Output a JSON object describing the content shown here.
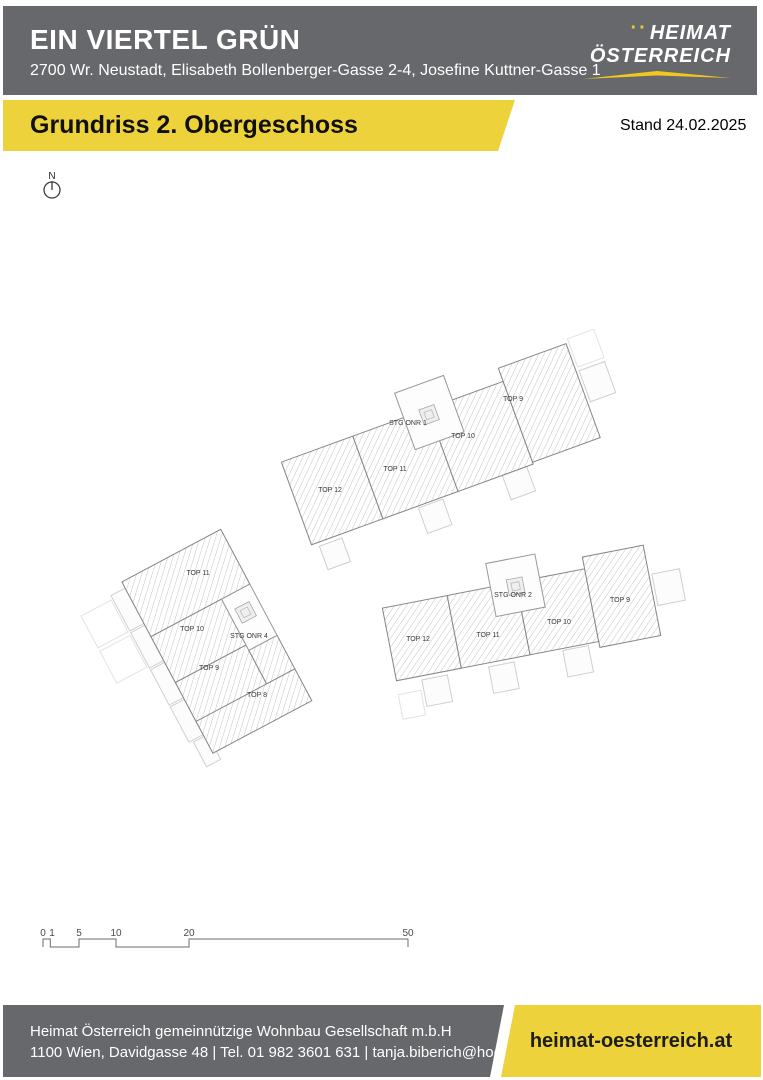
{
  "header": {
    "title": "EIN VIERTEL GRÜN",
    "address": "2700 Wr. Neustadt, Elisabeth Bollenberger-Gasse 2-4, Josefine Kuttner-Gasse 1"
  },
  "logo": {
    "dots": "··",
    "line1": "HEIMAT",
    "line2": "ÖSTERREICH"
  },
  "banner": {
    "title": "Grundriss 2. Obergeschoss",
    "stand": "Stand 24.02.2025"
  },
  "plan": {
    "north_label": "N",
    "buildings": [
      {
        "name": "building-top",
        "stairwell": "STG ONR 1",
        "units": [
          "TOP 12",
          "TOP 11",
          "TOP 10",
          "TOP 9"
        ]
      },
      {
        "name": "building-left",
        "stairwell": "STG ONR 4",
        "units": [
          "TOP 11",
          "TOP 10",
          "TOP 9",
          "TOP 8"
        ]
      },
      {
        "name": "building-right",
        "stairwell": "STG ONR 2",
        "units": [
          "TOP 12",
          "TOP 11",
          "TOP 10",
          "TOP 9"
        ]
      }
    ],
    "scalebar": {
      "labels": [
        "0",
        "1",
        "5",
        "10",
        "20",
        "50"
      ]
    }
  },
  "footer": {
    "company": "Heimat Österreich gemeinnützige Wohnbau Gesellschaft m.b.H",
    "contact": "1100 Wien, Davidgasse 48 | Tel. 01 982 3601 631 | tanja.biberich@hoe.at",
    "website": "heimat-oesterreich.at"
  },
  "colors": {
    "gray": "#67686b",
    "yellow": "#edd23b",
    "gold": "#f2c71e"
  }
}
